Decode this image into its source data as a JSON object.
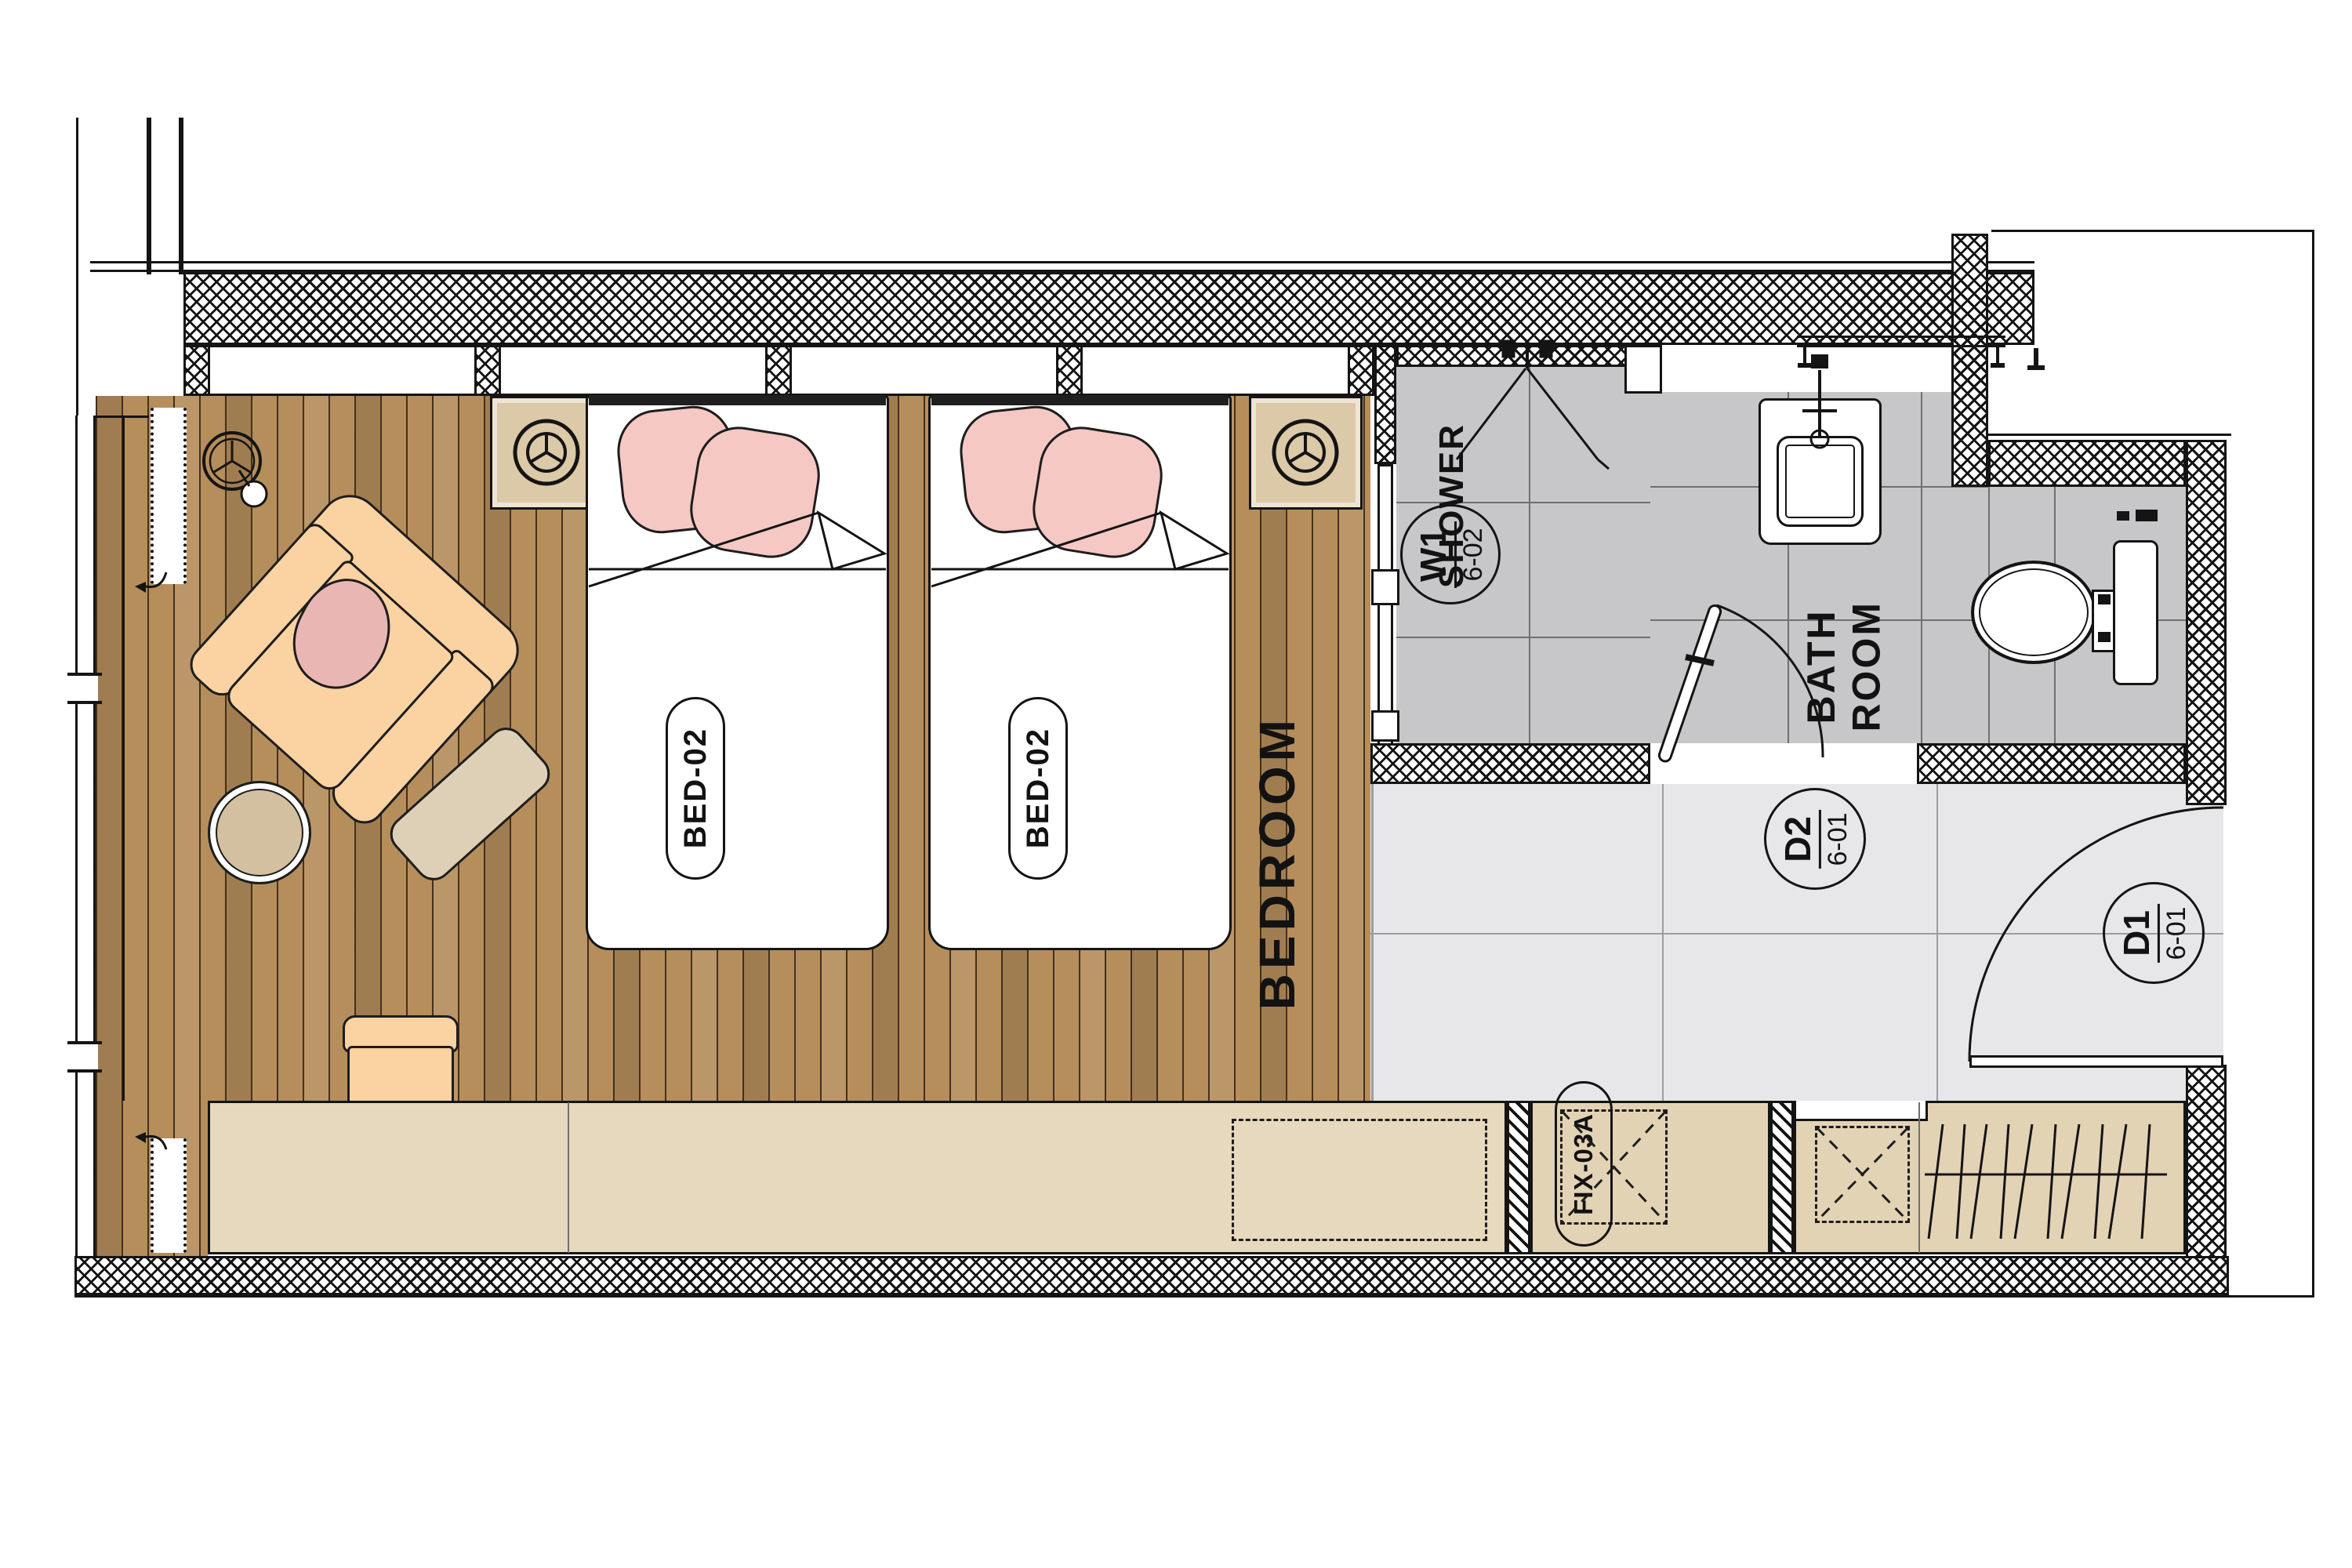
{
  "drawing": {
    "type": "hotel-guestroom-floor-plan",
    "rooms": {
      "bedroom_label": "BEDROOM",
      "shower_label": "SHOWER",
      "bathroom_label": "BATH\nROOM"
    },
    "beds": [
      {
        "label": "BED-02"
      },
      {
        "label": "BED-02"
      }
    ],
    "tags": {
      "window": {
        "code": "W1",
        "sheet": "6-02"
      },
      "door_bath": {
        "code": "D2",
        "sheet": "6-01"
      },
      "door_entry": {
        "code": "D1",
        "sheet": "6-01"
      }
    },
    "fixtures": {
      "millwork_label": "FIX-03A"
    },
    "colors": {
      "wood_floor": "#b68e5c",
      "bath_tile": "#c7c7ca",
      "entry_tile": "#e7e6e9",
      "counter": "#e7d9bd",
      "cabinet": "#e3d3b5",
      "armchair": "#fbd2a2",
      "cushion": "#eab6b3",
      "pillow": "#f5c8c4",
      "nightstand": "#dcc9a7",
      "line": "#141414"
    }
  }
}
